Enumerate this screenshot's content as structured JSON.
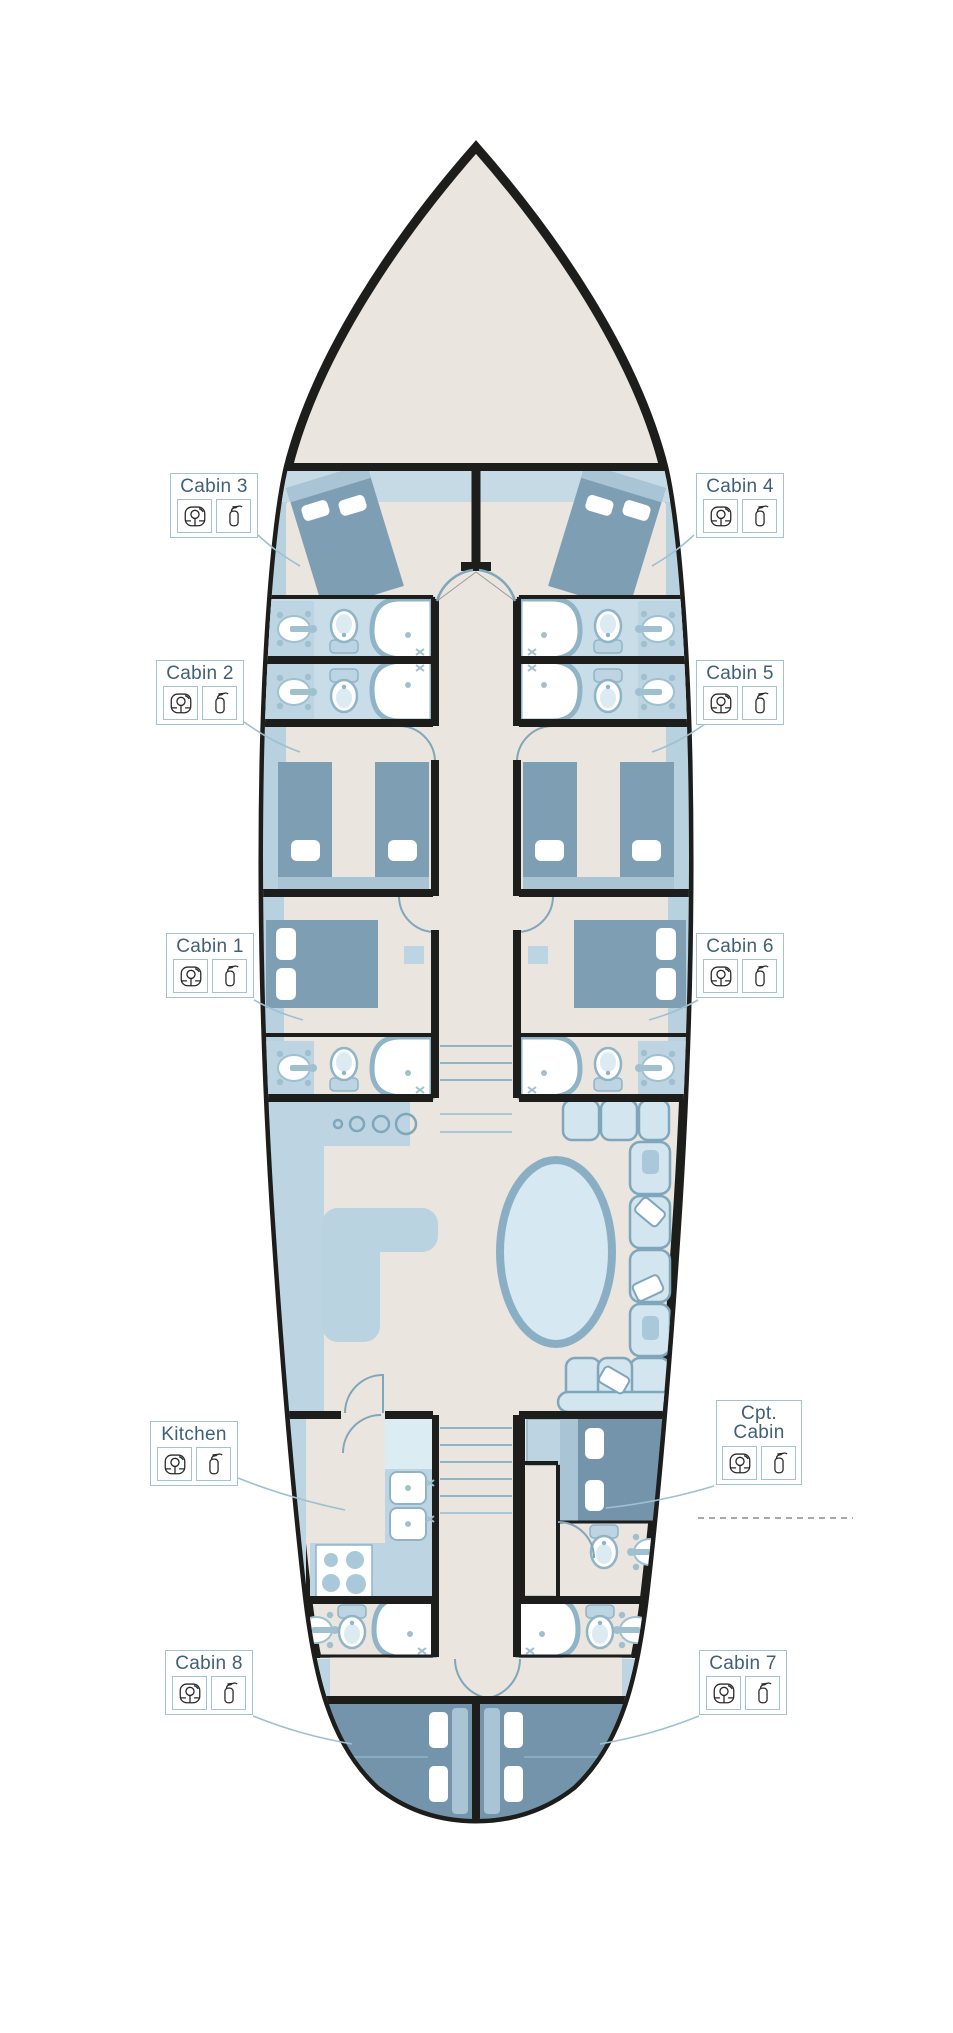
{
  "plan": {
    "type": "yacht-lower-deck-floor-plan",
    "labels": {
      "cabin1": {
        "text": "Cabin 1"
      },
      "cabin2": {
        "text": "Cabin 2"
      },
      "cabin3": {
        "text": "Cabin 3"
      },
      "cabin4": {
        "text": "Cabin 4"
      },
      "cabin5": {
        "text": "Cabin 5"
      },
      "cabin6": {
        "text": "Cabin 6"
      },
      "cabin7": {
        "text": "Cabin 7"
      },
      "cabin8": {
        "text": "Cabin 8"
      },
      "kitchen": {
        "text": "Kitchen"
      },
      "cpt_cabin": {
        "text": "Cpt. Cabin"
      }
    },
    "safety_icons": [
      "life-jacket",
      "fire-extinguisher"
    ],
    "colors": {
      "hull_fill": "#EAE5DE",
      "outline": "#1D1D1B",
      "bath_floor": "#C8DDE7",
      "lining": "#B7D1DE",
      "furniture": "#BDD5E2",
      "bed": "#7E9EB4",
      "bed_dark": "#7494AC",
      "fixture_border": "#8FB3C7",
      "label_border": "#A3C2D3",
      "label_text": "#40607A",
      "connector": "#9FC0D0",
      "dashed_line": "#8A8A8A"
    }
  }
}
